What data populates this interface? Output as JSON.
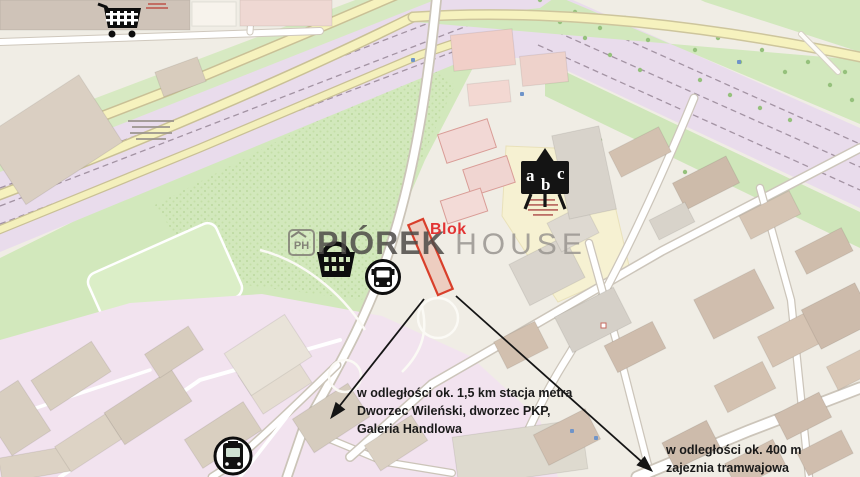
{
  "brand": {
    "logo_text": "PH",
    "name_primary": "PIÓREK",
    "name_secondary": "HOUSE"
  },
  "marker": {
    "label": "Blok"
  },
  "annotations": {
    "metro": {
      "line1": "w odległości ok. 1,5 km stacja metra",
      "line2": "Dworzec Wileński, dworzec PKP,",
      "line3": "Galeria Handlowa"
    },
    "tram_depot": {
      "line1": "w odległości ok. 400 m",
      "line2": "zajeznia tramwajowa"
    }
  },
  "school_icon": {
    "letters": [
      "a",
      "b",
      "c"
    ]
  },
  "icons": [
    "shopping-cart-icon",
    "shopping-basket-icon",
    "bus-stop-icon",
    "tram-stop-icon",
    "school-abc-icon",
    "ph-house-logo"
  ],
  "colors": {
    "marker_outline_red": "#d93f2b",
    "marker_fill": "rgba(232,146,124,0.35)",
    "label_red": "#e23434",
    "arrow_black": "#151515",
    "watermark_dark": "#4e4b48",
    "watermark_light": "#9a9691",
    "railway_lavender": "#e9dcec",
    "park_green": "#d2e8bc",
    "depot_pink": "#f2e3ef",
    "road_yellow": "#f6f2be",
    "building_brown": "#d0beae",
    "building_pink": "#f2d8d5"
  }
}
